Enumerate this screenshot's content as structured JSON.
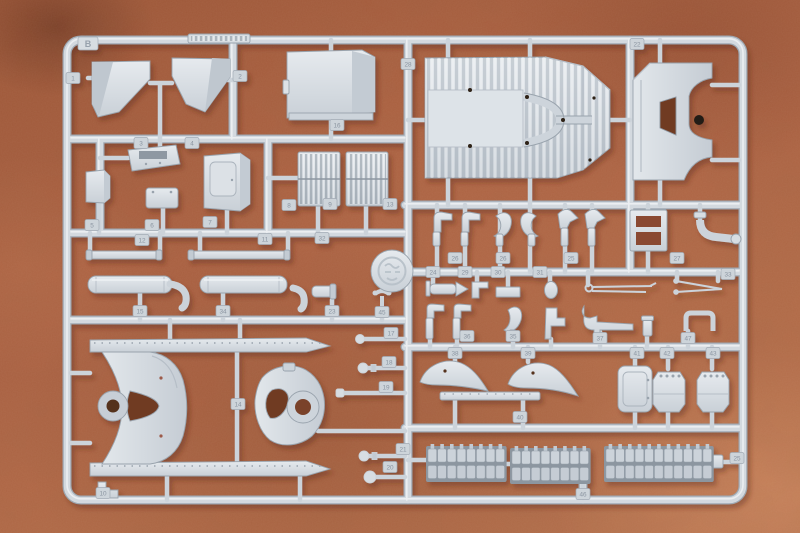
{
  "scene": {
    "description": "Photograph of a light grey injection-molded model kit sprue (parts runner) lying on a mottled terracotta suede surface",
    "object": "model-kit-sprue",
    "plastic_color_name": "light grey",
    "background_surface": "terracotta suede"
  },
  "sprue": {
    "letter": "B",
    "molded_strip": "illegible molded lettering on top rail",
    "logo_medallion": "round molded maker emblem",
    "part_tags": [
      {
        "x": 73,
        "y": 78,
        "label": "1"
      },
      {
        "x": 240,
        "y": 76,
        "label": "2"
      },
      {
        "x": 408,
        "y": 64,
        "label": "28"
      },
      {
        "x": 637,
        "y": 44,
        "label": "22"
      },
      {
        "x": 337,
        "y": 125,
        "label": "16"
      },
      {
        "x": 141,
        "y": 143,
        "label": "3"
      },
      {
        "x": 192,
        "y": 143,
        "label": "4"
      },
      {
        "x": 92,
        "y": 225,
        "label": "5"
      },
      {
        "x": 152,
        "y": 225,
        "label": "6"
      },
      {
        "x": 210,
        "y": 222,
        "label": "7"
      },
      {
        "x": 289,
        "y": 205,
        "label": "8"
      },
      {
        "x": 330,
        "y": 204,
        "label": "9"
      },
      {
        "x": 390,
        "y": 204,
        "label": "13"
      },
      {
        "x": 142,
        "y": 240,
        "label": "12"
      },
      {
        "x": 265,
        "y": 239,
        "label": "11"
      },
      {
        "x": 322,
        "y": 238,
        "label": "32"
      },
      {
        "x": 140,
        "y": 311,
        "label": "15"
      },
      {
        "x": 223,
        "y": 311,
        "label": "34"
      },
      {
        "x": 332,
        "y": 311,
        "label": "23"
      },
      {
        "x": 382,
        "y": 312,
        "label": "45"
      },
      {
        "x": 238,
        "y": 404,
        "label": "14"
      },
      {
        "x": 103,
        "y": 493,
        "label": "10"
      },
      {
        "x": 391,
        "y": 333,
        "label": "17"
      },
      {
        "x": 389,
        "y": 362,
        "label": "18"
      },
      {
        "x": 386,
        "y": 387,
        "label": "19"
      },
      {
        "x": 390,
        "y": 467,
        "label": "20"
      },
      {
        "x": 403,
        "y": 449,
        "label": "21"
      },
      {
        "x": 455,
        "y": 258,
        "label": "26"
      },
      {
        "x": 503,
        "y": 258,
        "label": "26"
      },
      {
        "x": 571,
        "y": 258,
        "label": "25"
      },
      {
        "x": 677,
        "y": 258,
        "label": "27"
      },
      {
        "x": 433,
        "y": 272,
        "label": "24"
      },
      {
        "x": 465,
        "y": 272,
        "label": "29"
      },
      {
        "x": 498,
        "y": 272,
        "label": "30"
      },
      {
        "x": 540,
        "y": 272,
        "label": "31"
      },
      {
        "x": 728,
        "y": 274,
        "label": "33"
      },
      {
        "x": 467,
        "y": 336,
        "label": "36"
      },
      {
        "x": 513,
        "y": 336,
        "label": "35"
      },
      {
        "x": 600,
        "y": 338,
        "label": "37"
      },
      {
        "x": 688,
        "y": 338,
        "label": "47"
      },
      {
        "x": 455,
        "y": 353,
        "label": "38"
      },
      {
        "x": 528,
        "y": 353,
        "label": "39"
      },
      {
        "x": 637,
        "y": 353,
        "label": "41"
      },
      {
        "x": 667,
        "y": 353,
        "label": "42"
      },
      {
        "x": 713,
        "y": 353,
        "label": "43"
      },
      {
        "x": 520,
        "y": 417,
        "label": "40"
      },
      {
        "x": 737,
        "y": 458,
        "label": "25"
      },
      {
        "x": 583,
        "y": 494,
        "label": "46"
      }
    ],
    "track_runs": [
      {
        "x": 428,
        "y": 449,
        "cols": 8
      },
      {
        "x": 512,
        "y": 451,
        "cols": 8
      },
      {
        "x": 606,
        "y": 449,
        "cols": 11
      }
    ]
  },
  "colors": {
    "background": "#a55c3d",
    "background_dark": "#7d4129",
    "background_light": "#c07f58",
    "plastic": "#d4dae0",
    "plastic_light": "#eaeef2",
    "plastic_dark": "#a7b0b9",
    "tag_text": "#8b95a1",
    "hole_dark": "#2e2118",
    "cutout": "#6f3a24",
    "shadow": "#5a2b1a"
  }
}
